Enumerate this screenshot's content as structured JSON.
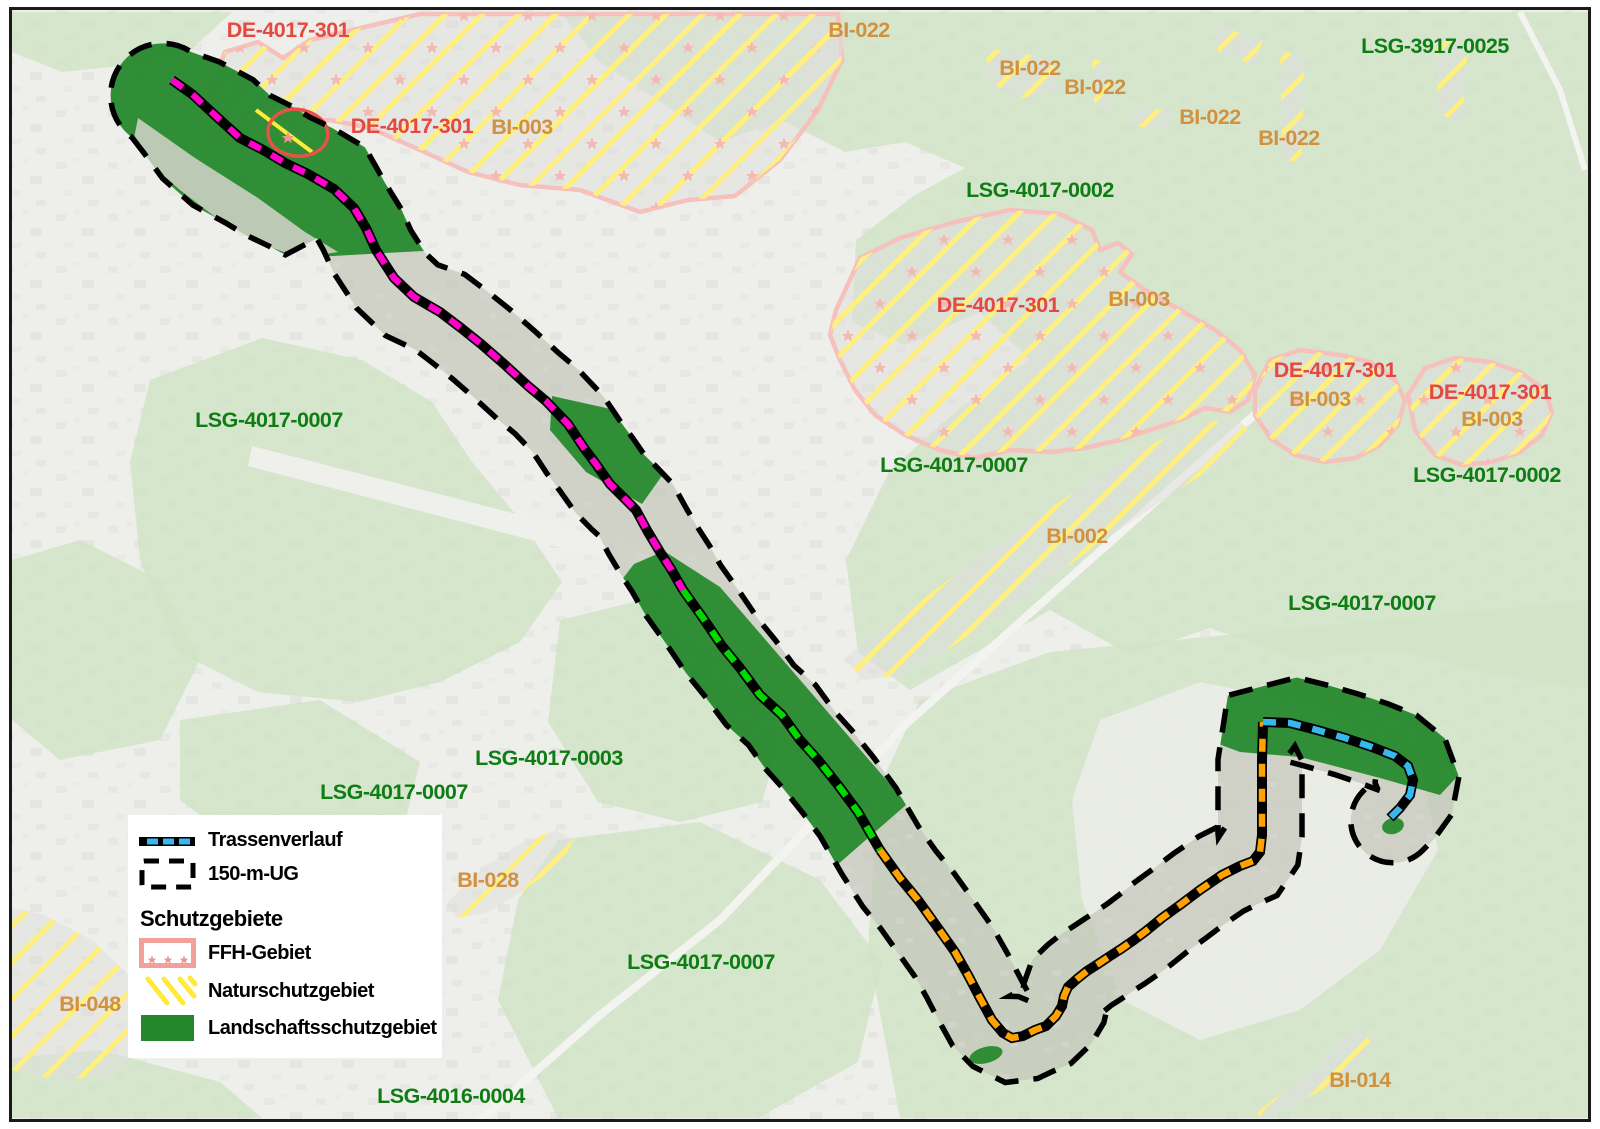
{
  "legend": {
    "trassenverlauf": "Trassenverlauf",
    "ug": "150-m-UG",
    "schutzgebiete": "Schutzgebiete",
    "ffh": "FFH-Gebiet",
    "nsg": "Naturschutzgebiet",
    "lsg": "Landschaftsschutzgebiet"
  },
  "colors": {
    "page_bg": "#ffffff",
    "map_border": "#1a1a1a",
    "base_gray": "#e6e7e2",
    "lsg_light_green": "#b9d6aa",
    "lsg_dark_green": "#22882a",
    "nsg_hatch_yellow": "#ffe93a",
    "ffh_outline": "#f2a09a",
    "ffh_star": "#f0958e",
    "ffh_detail_red": "#e85248",
    "trasse_magenta": "#ff00c8",
    "trasse_green": "#00d800",
    "trasse_orange": "#ffa200",
    "trasse_cyan": "#35b9ec",
    "corridor_black": "#000000",
    "label_red": "#e64741",
    "label_orange": "#d2913f",
    "label_green": "#0f7d14"
  },
  "map_labels": [
    {
      "text": "DE-4017-301",
      "x": 288,
      "y": 37,
      "color": "red"
    },
    {
      "text": "BI-022",
      "x": 859,
      "y": 37,
      "color": "orange"
    },
    {
      "text": "BI-022",
      "x": 1030,
      "y": 75,
      "color": "orange"
    },
    {
      "text": "BI-022",
      "x": 1095,
      "y": 94,
      "color": "orange"
    },
    {
      "text": "LSG-3917-0025",
      "x": 1435,
      "y": 53,
      "color": "green"
    },
    {
      "text": "BI-022",
      "x": 1210,
      "y": 124,
      "color": "orange"
    },
    {
      "text": "BI-022",
      "x": 1289,
      "y": 145,
      "color": "orange"
    },
    {
      "text": "DE-4017-301",
      "x": 412,
      "y": 133,
      "color": "red"
    },
    {
      "text": "BI-003",
      "x": 522,
      "y": 134,
      "color": "orange"
    },
    {
      "text": "LSG-4017-0002",
      "x": 1040,
      "y": 197,
      "color": "green"
    },
    {
      "text": "DE-4017-301",
      "x": 998,
      "y": 312,
      "color": "red"
    },
    {
      "text": "BI-003",
      "x": 1139,
      "y": 306,
      "color": "orange"
    },
    {
      "text": "DE-4017-301",
      "x": 1335,
      "y": 377,
      "color": "red"
    },
    {
      "text": "BI-003",
      "x": 1320,
      "y": 406,
      "color": "orange"
    },
    {
      "text": "DE-4017-301",
      "x": 1490,
      "y": 399,
      "color": "red"
    },
    {
      "text": "BI-003",
      "x": 1492,
      "y": 426,
      "color": "orange"
    },
    {
      "text": "LSG-4017-0007",
      "x": 269,
      "y": 427,
      "color": "green"
    },
    {
      "text": "LSG-4017-0002",
      "x": 1487,
      "y": 482,
      "color": "green"
    },
    {
      "text": "LSG-4017-0007",
      "x": 954,
      "y": 472,
      "color": "green"
    },
    {
      "text": "BI-002",
      "x": 1077,
      "y": 543,
      "color": "orange"
    },
    {
      "text": "LSG-4017-0007",
      "x": 1362,
      "y": 610,
      "color": "green"
    },
    {
      "text": "LSG-4017-0003",
      "x": 549,
      "y": 765,
      "color": "green"
    },
    {
      "text": "LSG-4017-0007",
      "x": 394,
      "y": 799,
      "color": "green"
    },
    {
      "text": "BI-028",
      "x": 488,
      "y": 887,
      "color": "orange"
    },
    {
      "text": "BI-048",
      "x": 90,
      "y": 1011,
      "color": "orange"
    },
    {
      "text": "LSG-4017-0007",
      "x": 701,
      "y": 969,
      "color": "green"
    },
    {
      "text": "LSG-4016-0004",
      "x": 451,
      "y": 1103,
      "color": "green"
    },
    {
      "text": "BI-014",
      "x": 1360,
      "y": 1087,
      "color": "orange"
    }
  ]
}
